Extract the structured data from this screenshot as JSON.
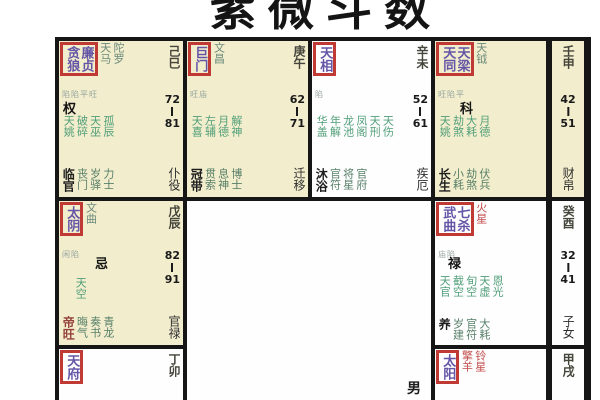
{
  "title": {
    "text": "紫微斗数"
  },
  "center": {
    "gender": "男"
  },
  "colors": {
    "cell_yellow": "#f2edcd",
    "cell_white": "#fefefe",
    "grid_border": "#161616",
    "highlight_box_red": "#bf3a35",
    "main_star_purple": "#6455a6",
    "minor_star_green": "#4f9e78",
    "red_star_text": "#c14b4b",
    "stem_text": "#45453c"
  },
  "cells": [
    {
      "name": "巳宫",
      "stem": "己巳",
      "age_from": "72",
      "age_to": "81",
      "palace": "仆役",
      "hua": "权",
      "box_stars": [
        "贪狼",
        "廉贞"
      ],
      "side_stars": [
        "天马",
        "陀罗"
      ],
      "note": "陷陷平旺",
      "green_stars": [
        "天姚",
        "破碎",
        "天巫",
        "孤辰"
      ],
      "bottom_first": "临官",
      "bottom_stars": [
        "丧门",
        "岁驿",
        "力士"
      ]
    },
    {
      "name": "午宫",
      "stem": "庚午",
      "age_from": "62",
      "age_to": "71",
      "palace": "迁移",
      "hua": "",
      "box_stars": [
        "巨门"
      ],
      "side_stars": [
        "文昌"
      ],
      "note": "旺庙",
      "green_stars": [
        "天喜",
        "左辅",
        "月德",
        "解神"
      ],
      "bottom_first": "冠带",
      "bottom_stars": [
        "贯索",
        "息神",
        "博士"
      ]
    },
    {
      "name": "未宫",
      "stem": "辛未",
      "age_from": "52",
      "age_to": "61",
      "palace": "疾厄",
      "hua": "",
      "box_stars": [
        "天相"
      ],
      "side_stars": [],
      "note": "陷",
      "green_stars": [
        "华盖",
        "年解",
        "龙池",
        "凤阁",
        "天刑",
        "天伤"
      ],
      "bottom_first": "沐浴",
      "bottom_stars": [
        "官符",
        "将星",
        "官府"
      ]
    },
    {
      "name": "申宫",
      "stem": "壬申",
      "age_from": "42",
      "age_to": "51",
      "palace": "财帛",
      "hua": "科",
      "box_stars": [
        "天同",
        "天梁"
      ],
      "side_stars": [
        "天钺"
      ],
      "note": "旺陷平",
      "green_stars": [
        "天姚",
        "劫煞",
        "大耗",
        "月德"
      ],
      "bottom_first": "长生",
      "bottom_stars": [
        "小耗",
        "劫煞",
        "伏兵"
      ]
    },
    {
      "name": "辰宫",
      "stem": "戊辰",
      "age_from": "82",
      "age_to": "91",
      "palace": "官禄",
      "hua": "忌",
      "box_stars": [
        "太阴"
      ],
      "side_stars": [
        "文曲"
      ],
      "note": "闲陷",
      "green_stars": [
        "天空"
      ],
      "bottom_first": "帝旺",
      "bottom_stars": [
        "晦气",
        "奏书",
        "青龙"
      ]
    },
    {
      "name": "酉宫",
      "stem": "癸酉",
      "age_from": "32",
      "age_to": "41",
      "palace": "子女",
      "hua": "禄",
      "box_stars": [
        "武曲",
        "七杀"
      ],
      "side_stars": [
        "火星"
      ],
      "note": "庙陷",
      "green_stars": [
        "天官",
        "截空",
        "旬空",
        "天虚",
        "恩光"
      ],
      "bottom_first": "养",
      "bottom_stars": [
        "岁建",
        "官符",
        "大耗"
      ]
    },
    {
      "name": "卯宫",
      "stem": "丁卯",
      "age_from": "",
      "age_to": "",
      "palace": "",
      "hua": "",
      "box_stars": [
        "天府"
      ],
      "side_stars": [],
      "note": "",
      "green_stars": [],
      "bottom_first": "",
      "bottom_stars": []
    },
    {
      "name": "戌宫",
      "stem": "甲戌",
      "age_from": "",
      "age_to": "",
      "palace": "",
      "hua": "",
      "box_stars": [
        "太阳"
      ],
      "side_stars": [
        "擎羊",
        "铃星"
      ],
      "note": "陷庙",
      "green_stars": [],
      "bottom_first": "",
      "bottom_stars": []
    }
  ]
}
